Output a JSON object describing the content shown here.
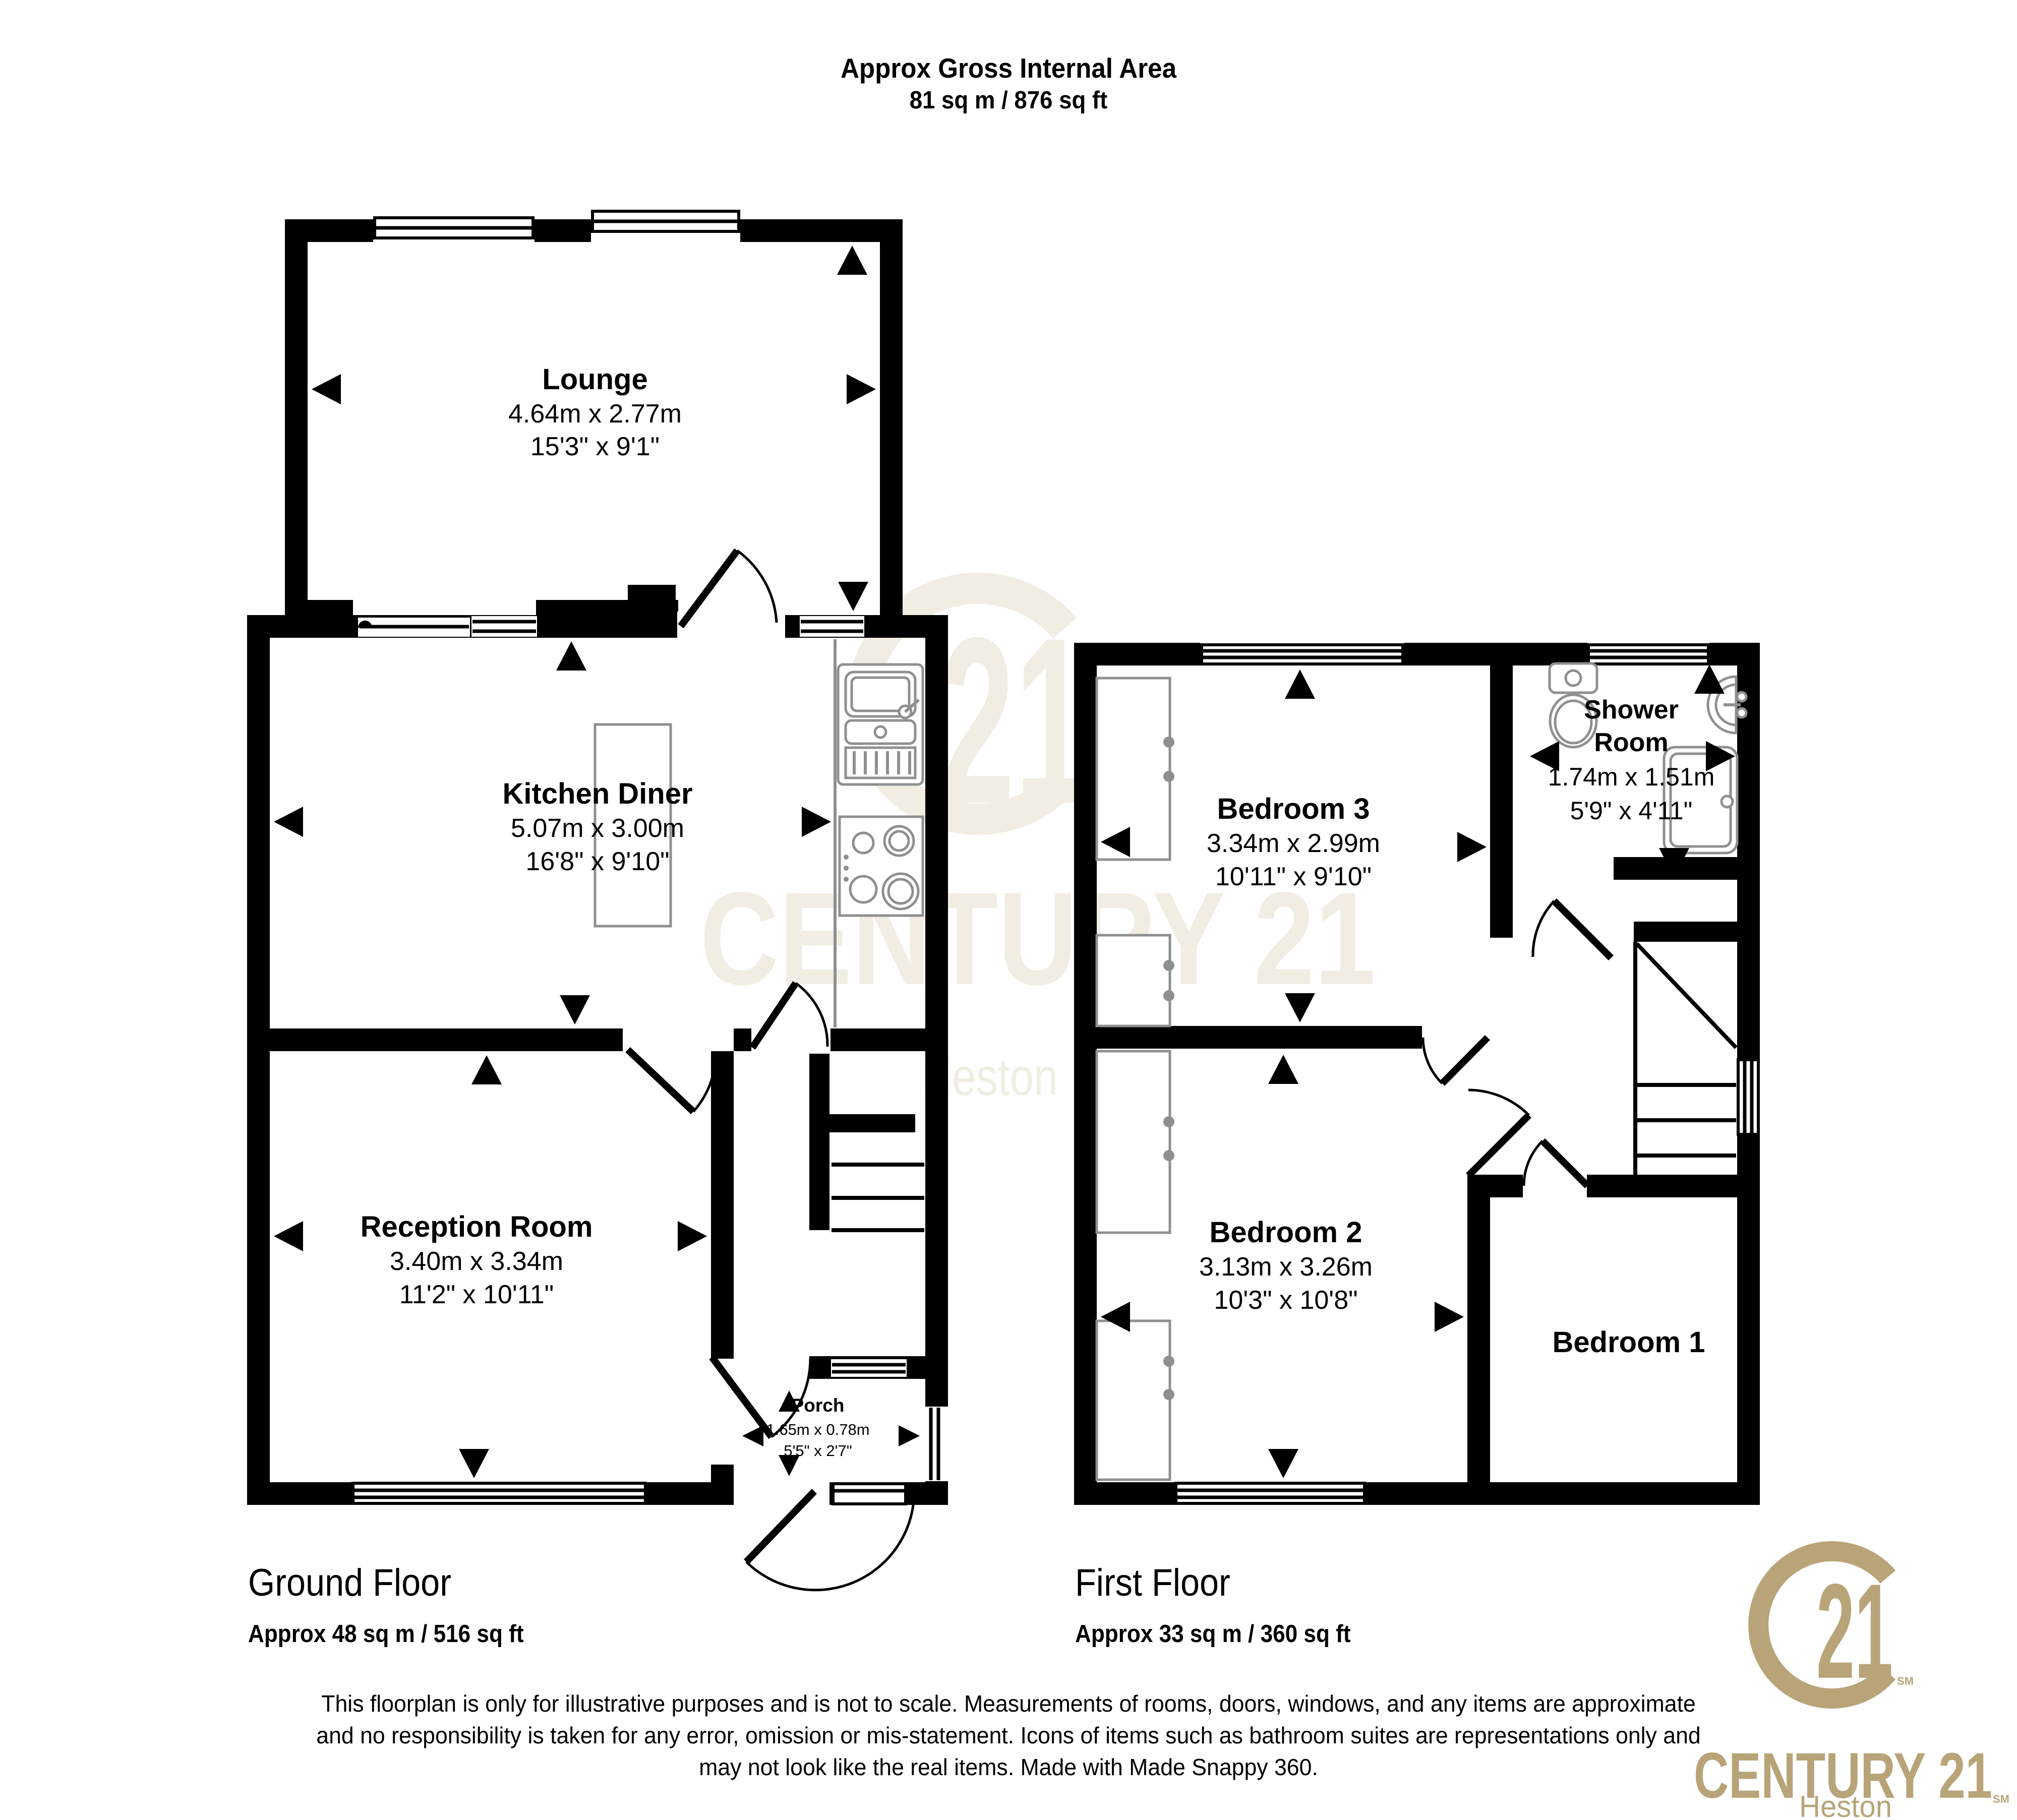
{
  "header": {
    "title": "Approx Gross Internal Area",
    "area": "81 sq m / 876 sq ft"
  },
  "ground_floor": {
    "label": "Ground Floor",
    "area": "Approx 48 sq m / 516 sq ft",
    "rooms": {
      "lounge": {
        "name": "Lounge",
        "metric": "4.64m x 2.77m",
        "imperial": "15'3\" x 9'1\""
      },
      "kitchen_diner": {
        "name": "Kitchen Diner",
        "metric": "5.07m x 3.00m",
        "imperial": "16'8\" x 9'10\""
      },
      "reception": {
        "name": "Reception Room",
        "metric": "3.40m x 3.34m",
        "imperial": "11'2\" x 10'11\""
      },
      "porch": {
        "name": "Porch",
        "metric": "1.65m x 0.78m",
        "imperial": "5'5\" x 2'7\""
      }
    }
  },
  "first_floor": {
    "label": "First Floor",
    "area": "Approx 33 sq m / 360 sq ft",
    "rooms": {
      "bedroom3": {
        "name": "Bedroom 3",
        "metric": "3.34m x 2.99m",
        "imperial": "10'11\" x 9'10\""
      },
      "shower_room": {
        "name_line1": "Shower",
        "name_line2": "Room",
        "metric": "1.74m x 1.51m",
        "imperial": "5'9\" x 4'11\""
      },
      "bedroom2": {
        "name": "Bedroom 2",
        "metric": "3.13m x 3.26m",
        "imperial": "10'3\" x 10'8\""
      },
      "bedroom1": {
        "name": "Bedroom 1"
      }
    }
  },
  "disclaimer": {
    "lines": [
      "This floorplan is only for illustrative purposes and is not to scale. Measurements of rooms, doors, windows, and any items are approximate",
      "and no responsibility is taken for any error, omission or mis-statement. Icons of items such as bathroom suites are representations only and",
      "may not look like the real items. Made with Made Snappy 360."
    ]
  },
  "branding": {
    "name": "CENTURY 21",
    "office": "Heston",
    "number": "21",
    "sm": "SM",
    "gold": "#b8a478",
    "watermark": "#f1ede2"
  }
}
